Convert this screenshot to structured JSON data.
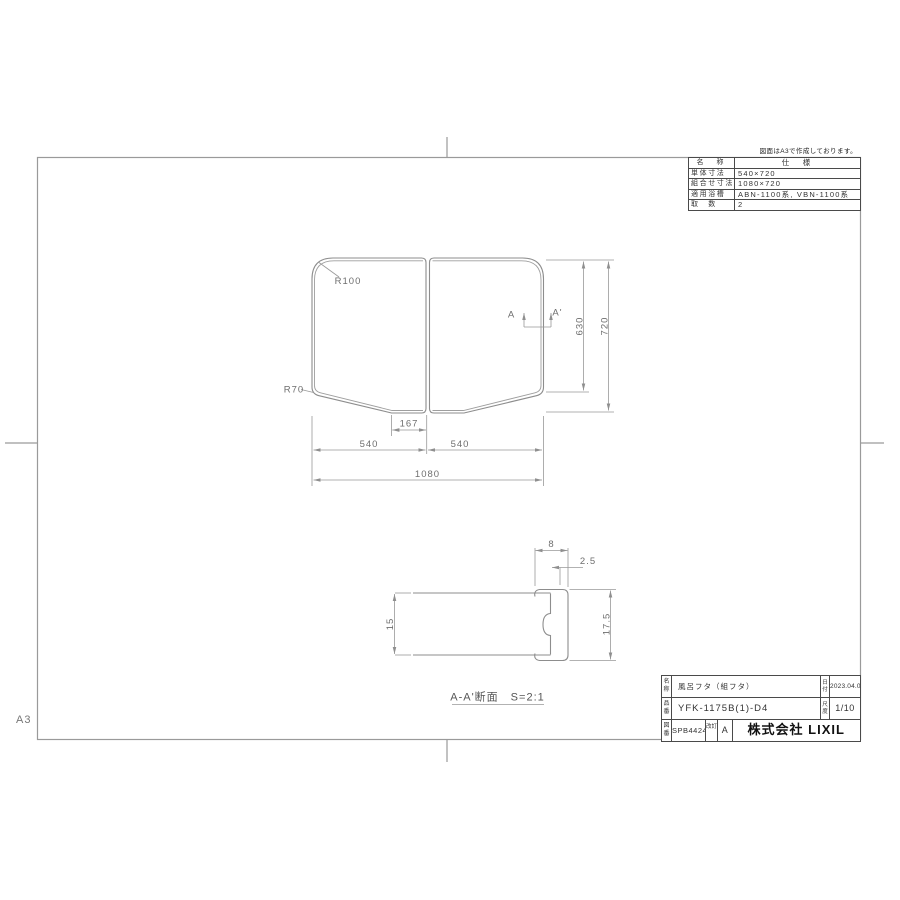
{
  "page": {
    "note": "図面はA3で作成しております。",
    "sheet_size": "A3"
  },
  "spec_table": {
    "col_name": "名　称",
    "col_spec": "仕　様",
    "rows": [
      {
        "label": "単体寸法",
        "value": "540×720"
      },
      {
        "label": "組合せ寸法",
        "value": "1080×720"
      },
      {
        "label": "適用浴槽",
        "value": "ABN-1100系, VBN-1100系"
      },
      {
        "label": "取　数",
        "value": "2"
      }
    ]
  },
  "plan_view": {
    "r_top_left": "R100",
    "r_bottom_left": "R70",
    "section_a": "A",
    "section_a_prime": "A'",
    "dim_height_upper": "630",
    "dim_height_total": "720",
    "dim_flat": "167",
    "dim_width_left": "540",
    "dim_width_right": "540",
    "dim_width_total": "1080"
  },
  "section_view": {
    "dim_lip_width": "8",
    "dim_offset": "2.5",
    "dim_thickness": "15",
    "dim_edge_height": "17.5",
    "caption": "A-A'断面　S=2:1"
  },
  "title_block": {
    "name_label": "名称",
    "name_value": "風呂フタ（組フタ）",
    "date_label": "日付",
    "date_value": "2023.04.03",
    "part_label": "品番",
    "part_value": "YFK-1175B(1)-D4",
    "scale_label": "尺度",
    "scale_value": "1/10",
    "drawing_label": "図番",
    "drawing_value": "SPB4424",
    "rev_label": "改訂",
    "rev_value": "A",
    "company": "株式会社 LIXIL"
  }
}
